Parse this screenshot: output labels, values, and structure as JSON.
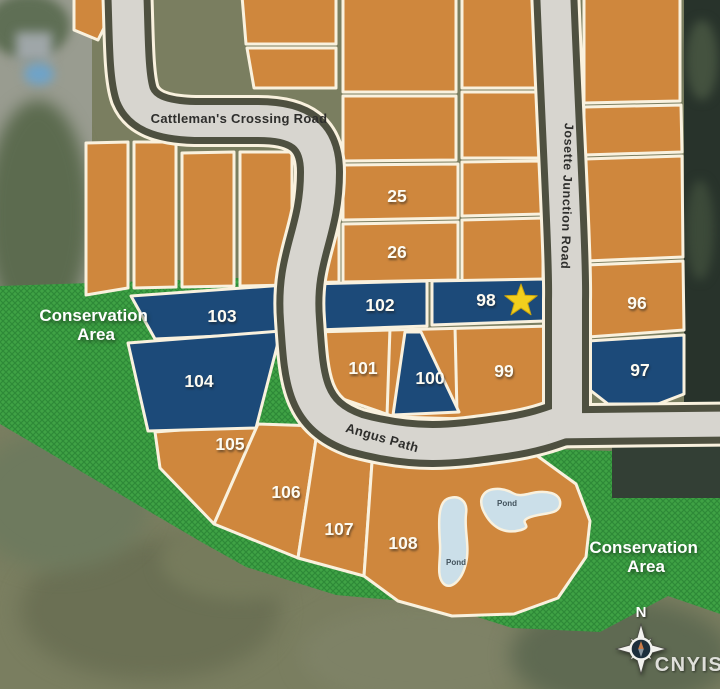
{
  "lots": [
    {
      "number": "25",
      "color": "orange"
    },
    {
      "number": "26",
      "color": "orange"
    },
    {
      "number": "96",
      "color": "orange"
    },
    {
      "number": "97",
      "color": "navy"
    },
    {
      "number": "98",
      "color": "navy",
      "featured": true
    },
    {
      "number": "99",
      "color": "orange"
    },
    {
      "number": "100",
      "color": "navy"
    },
    {
      "number": "101",
      "color": "orange"
    },
    {
      "number": "102",
      "color": "navy"
    },
    {
      "number": "103",
      "color": "navy"
    },
    {
      "number": "104",
      "color": "navy"
    },
    {
      "number": "105",
      "color": "orange"
    },
    {
      "number": "106",
      "color": "orange"
    },
    {
      "number": "107",
      "color": "orange"
    },
    {
      "number": "108",
      "color": "orange"
    }
  ],
  "roads": {
    "cattlemans_crossing": "Cattleman's Crossing Road",
    "josette_junction": "Josette Junction Road",
    "angus_path": "Angus Path"
  },
  "labels": {
    "conservation_line1": "Conservation",
    "conservation_line2": "Area",
    "pond": "Pond",
    "north": "N",
    "watermark": "CNYIS"
  },
  "featured_lot": {
    "number": "98",
    "marker": "star-icon"
  },
  "colors": {
    "lot_available_navy": "#1C4A79",
    "lot_orange": "#CF873D",
    "lot_border": "#F9F1DE",
    "road_fill": "#D7D5CF",
    "road_edge": "#4E5040",
    "conservation_green": "#3FA245",
    "conservation_hatch": "#2E8A37",
    "pond_blue": "#CBDFE9",
    "star_yellow": "#F2CF1D"
  }
}
